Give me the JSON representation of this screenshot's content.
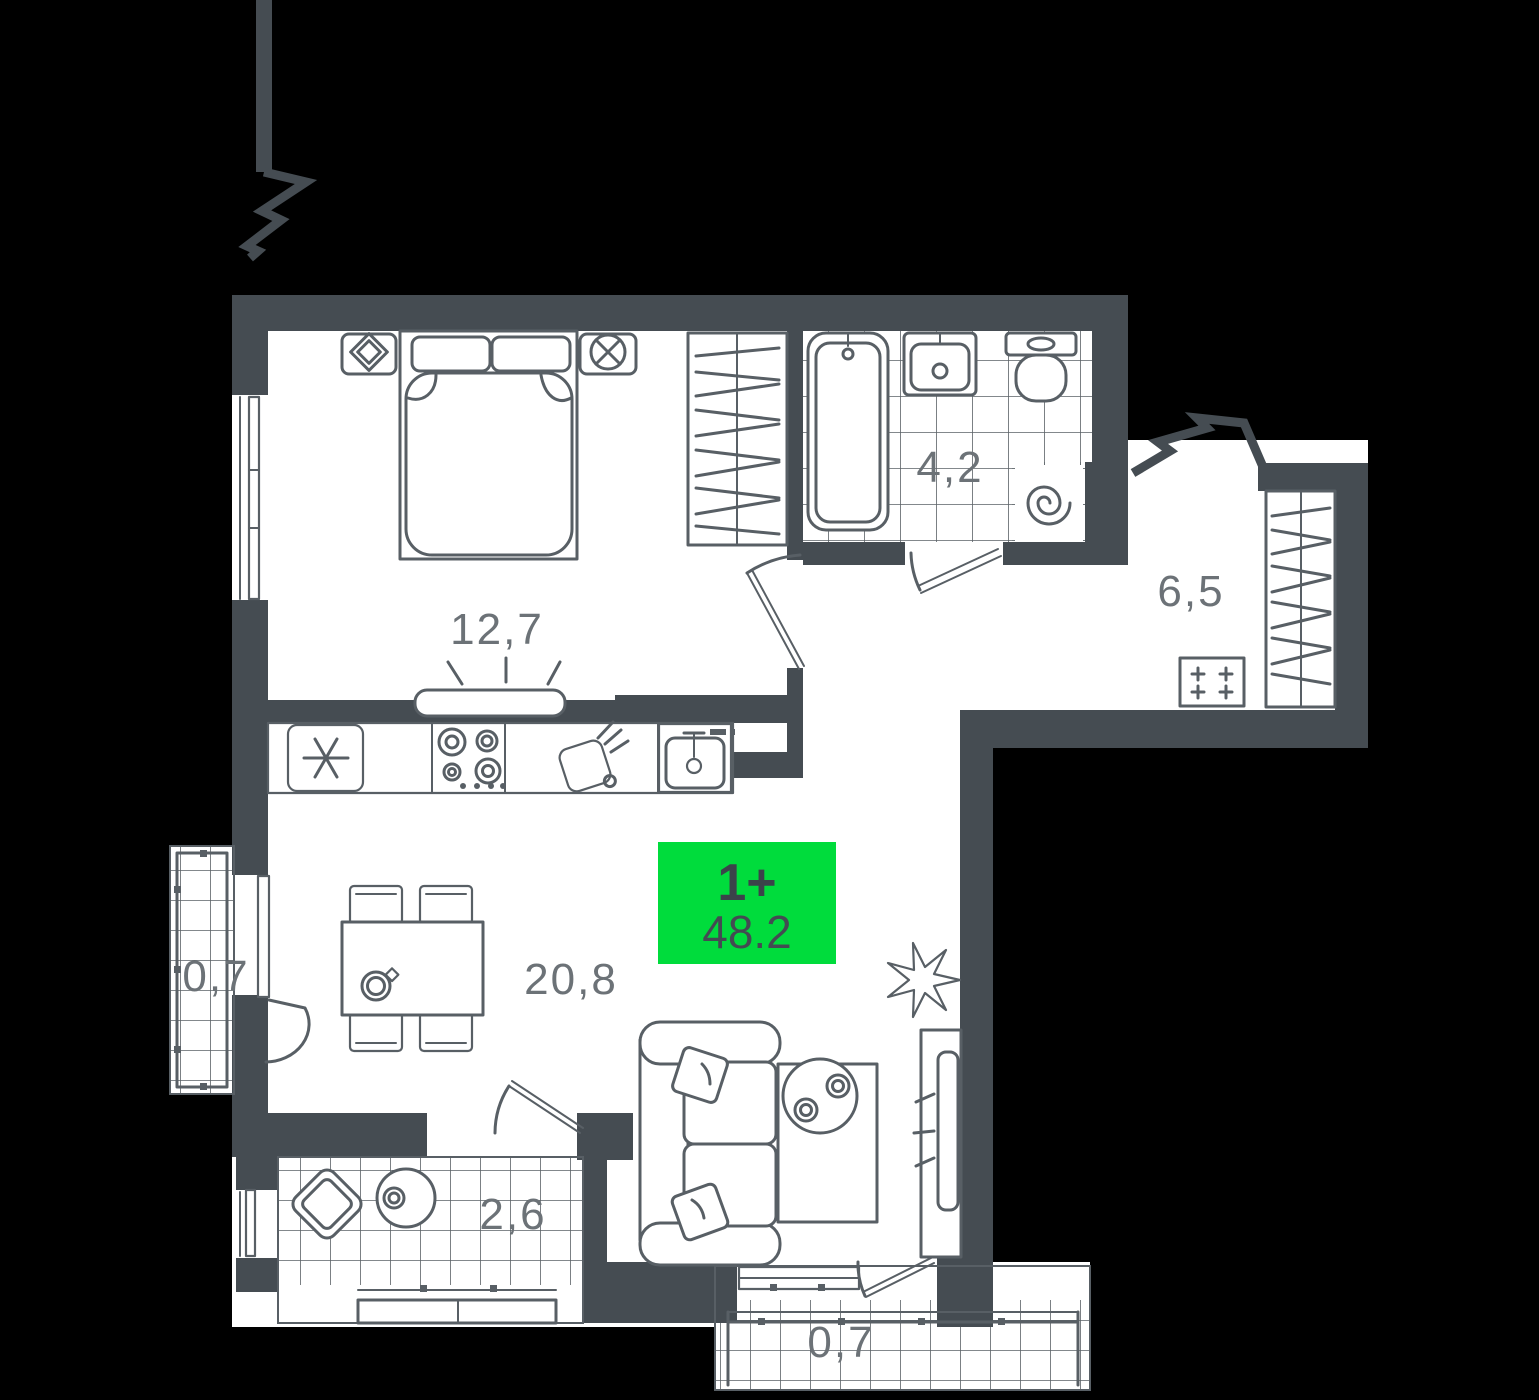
{
  "apartment": {
    "type_badge": {
      "label": "1+",
      "area": "48.2"
    },
    "rooms": {
      "bedroom": {
        "area": "12,7"
      },
      "bathroom": {
        "area": "4,2"
      },
      "hallway": {
        "area": "6,5"
      },
      "living_kitchen": {
        "area": "20,8"
      },
      "balcony_left": {
        "area": "0,7"
      },
      "balcony_bottom_left": {
        "area": "2,6"
      },
      "balcony_bottom": {
        "area": "0,7"
      }
    },
    "colors": {
      "badge_green": "#00dc3c",
      "wall": "#454c52",
      "background": "#000000"
    }
  }
}
